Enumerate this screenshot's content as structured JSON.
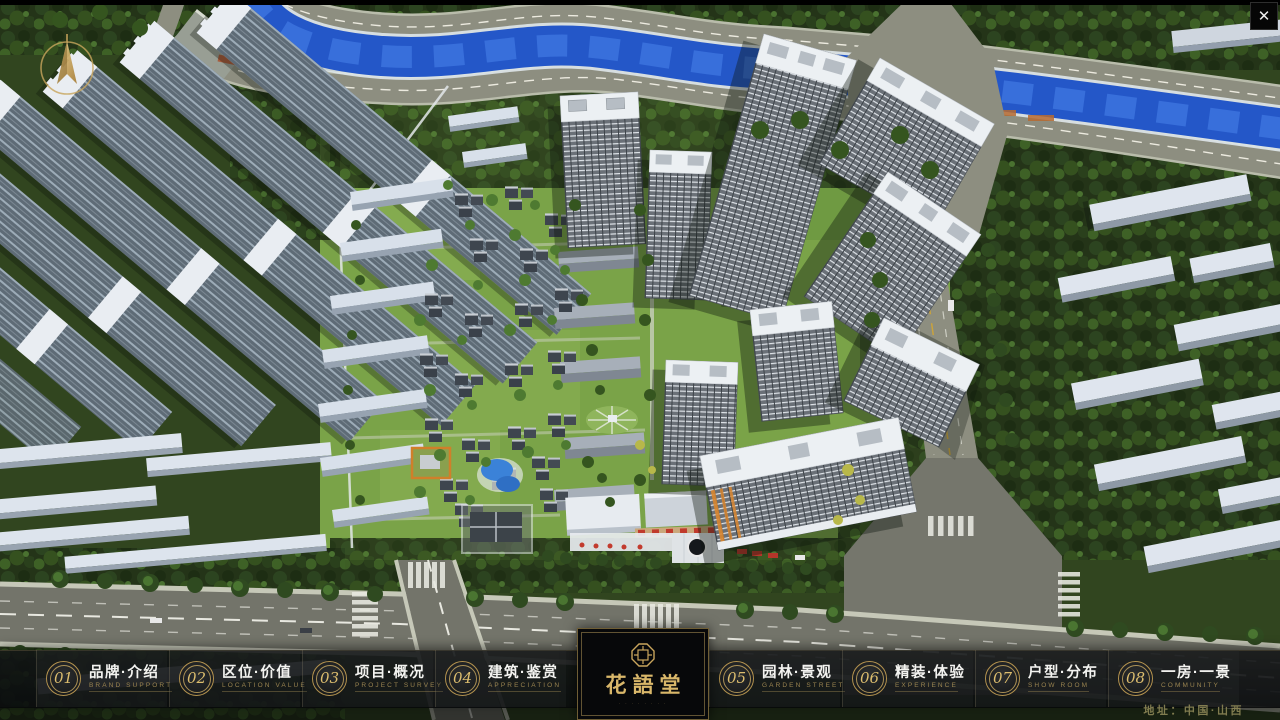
{
  "view": {
    "close_glyph": "✕"
  },
  "menu": {
    "items": [
      {
        "number": "01",
        "title": "品牌·介绍",
        "subtitle": "BRAND SUPPORT"
      },
      {
        "number": "02",
        "title": "区位·价值",
        "subtitle": "LOCATION VALUE"
      },
      {
        "number": "03",
        "title": "项目·概况",
        "subtitle": "PROJECT SURVEY"
      },
      {
        "number": "04",
        "title": "建筑·鉴赏",
        "subtitle": "APPRECIATION"
      },
      {
        "number": "05",
        "title": "园林·景观",
        "subtitle": "GARDEN STREET"
      },
      {
        "number": "06",
        "title": "精装·体验",
        "subtitle": "EXPERIENCE"
      },
      {
        "number": "07",
        "title": "户型·分布",
        "subtitle": "SHOW ROOM"
      },
      {
        "number": "08",
        "title": "一房·一景",
        "subtitle": "COMMUNITY"
      }
    ]
  },
  "logo": {
    "title": "花語堂",
    "caption": "· · · · · · · ·"
  },
  "footer": {
    "address": "地址：中国·山西"
  },
  "colors": {
    "gold_accent": "#c5a05a",
    "bar_background": "rgba(14,16,18,0.88)",
    "river_blue": "#2457c8",
    "lawn_green": "#7aa348"
  }
}
